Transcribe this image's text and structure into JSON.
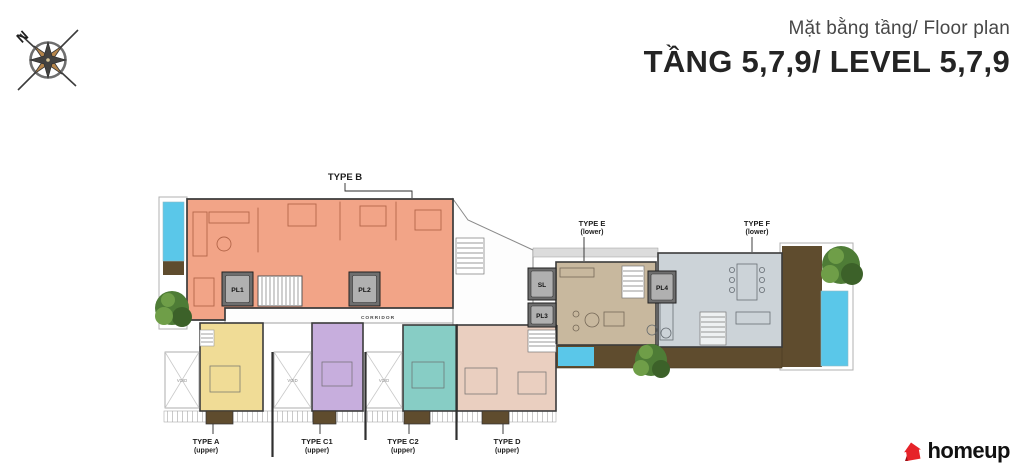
{
  "header": {
    "subtitle": "Mặt bằng tầng/ Floor plan",
    "title": "TẦNG 5,7,9/ LEVEL 5,7,9"
  },
  "compass": {
    "north_label": "N"
  },
  "floor_plan": {
    "corridor_label": "CORRIDOR",
    "void_label": "VOID",
    "units": [
      {
        "id": "type-b",
        "label": "TYPE B",
        "sublabel": "",
        "color": "#f2a487"
      },
      {
        "id": "type-e",
        "label": "TYPE E",
        "sublabel": "(lower)",
        "color": "#c8b89e"
      },
      {
        "id": "type-f",
        "label": "TYPE F",
        "sublabel": "(lower)",
        "color": "#ccd3d8"
      },
      {
        "id": "type-a",
        "label": "TYPE A",
        "sublabel": "(upper)",
        "color": "#f0dc96"
      },
      {
        "id": "type-c1",
        "label": "TYPE C1",
        "sublabel": "(upper)",
        "color": "#c7aedd"
      },
      {
        "id": "type-c2",
        "label": "TYPE C2",
        "sublabel": "(upper)",
        "color": "#87cdc5"
      },
      {
        "id": "type-d",
        "label": "TYPE D",
        "sublabel": "(upper)",
        "color": "#eacfc0"
      }
    ],
    "elevators": [
      {
        "id": "pl1",
        "label": "PL1"
      },
      {
        "id": "pl2",
        "label": "PL2"
      },
      {
        "id": "sl",
        "label": "SL"
      },
      {
        "id": "pl3",
        "label": "PL3"
      },
      {
        "id": "pl4",
        "label": "PL4"
      }
    ],
    "colors": {
      "pool": "#5ac7e9",
      "wood_deck": "#5f4c2e",
      "tree": "#4e7c36",
      "wall": "#3b3b3b",
      "elevator_box": "#6e6e6e"
    }
  },
  "footer": {
    "brand": "homeup",
    "brand_color": "#e62329"
  }
}
